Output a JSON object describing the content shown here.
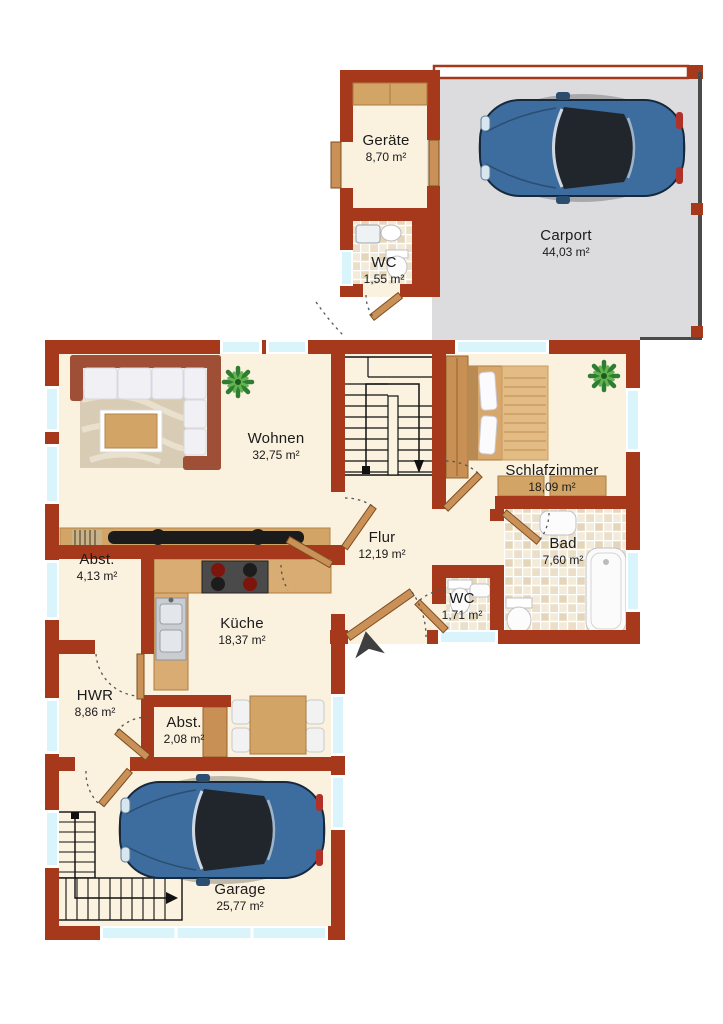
{
  "rooms": [
    {
      "name": "Geräte",
      "area": "8,70 m²"
    },
    {
      "name": "WC",
      "area": "1,55 m²"
    },
    {
      "name": "Carport",
      "area": "44,03 m²"
    },
    {
      "name": "Wohnen",
      "area": "32,75 m²"
    },
    {
      "name": "Schlafzimmer",
      "area": "18,09 m²"
    },
    {
      "name": "Flur",
      "area": "12,19 m²"
    },
    {
      "name": "Bad",
      "area": "7,60 m²"
    },
    {
      "name": "WC",
      "area": "1,71 m²"
    },
    {
      "name": "Abst.",
      "area": "4,13 m²"
    },
    {
      "name": "Küche",
      "area": "18,37 m²"
    },
    {
      "name": "HWR",
      "area": "8,86 m²"
    },
    {
      "name": "Abst.",
      "area": "2,08 m²"
    },
    {
      "name": "Garage",
      "area": "25,77 m²"
    }
  ],
  "colors": {
    "wall": "#A6391B",
    "floor": "#FAF1DE",
    "carport_floor": "#DCDCDE",
    "window": "#D9F4FB",
    "wood": "#D2A567",
    "door_wood": "#C99157",
    "car_body": "#3C6D9E",
    "plant": "#2E7D32",
    "tile_light": "#F3EBDA",
    "tile_dark": "#E5D6BA",
    "text": "#1B1B1B"
  },
  "icons": {
    "car": "top-view-car",
    "plant": "potted-plant",
    "staircase": "stairs-with-direction-arrow",
    "north_arrow": "entrance-direction-arrow",
    "door": "door-leaf-with-swing-arc",
    "window": "window-glass-band"
  }
}
